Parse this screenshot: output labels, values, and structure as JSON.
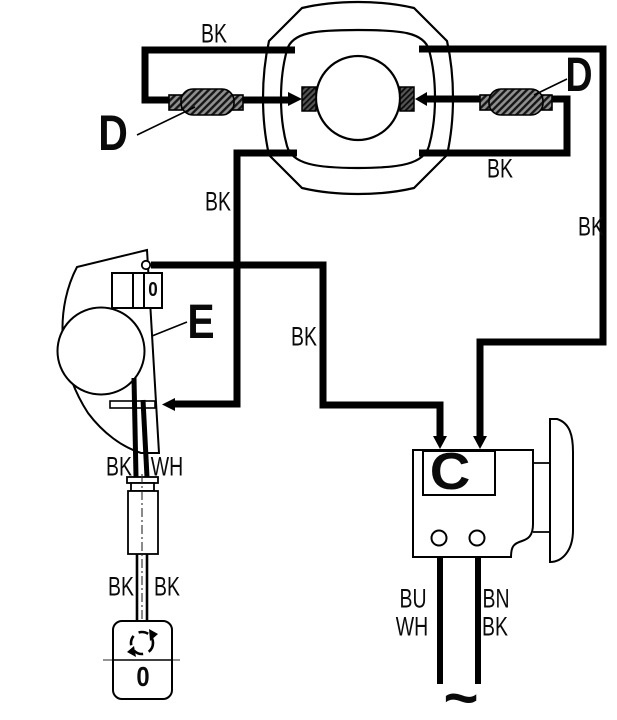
{
  "diagram_type": "wiring-diagram",
  "colors": {
    "line": "#000000",
    "background": "#ffffff",
    "connector_hatch": "#8f8f8f"
  },
  "components": {
    "flywheel_magneto": {
      "name": "flywheel magneto stator"
    },
    "bullet_connector_left": {
      "label": "D"
    },
    "bullet_connector_right": {
      "label": "D"
    },
    "ignition_coil": {
      "label": "E",
      "marking": "0"
    },
    "regulator_box": {
      "label": "C"
    },
    "key_switch": {
      "position_marking": "0"
    },
    "ac_source_symbol": "~"
  },
  "wire_labels": {
    "top_left": "BK",
    "stator_down_left": "BK",
    "loop_bottom_right": "BK",
    "right_vertical": "BK",
    "coil_to_regulator": "BK",
    "coil_out_left": "BK",
    "coil_out_right": "WH",
    "switch_lead_left": "BK",
    "switch_lead_right": "BK",
    "output_left_line1": "BU",
    "output_left_line2": "WH",
    "output_right_line1": "BN",
    "output_right_line2": "BK"
  }
}
